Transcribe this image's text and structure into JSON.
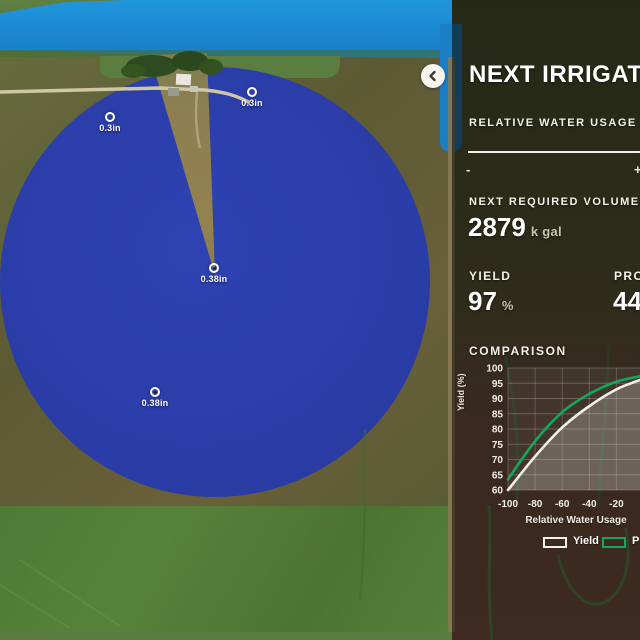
{
  "map": {
    "markers": [
      {
        "x": 252,
        "y": 92,
        "label": "0.3in",
        "dot": false
      },
      {
        "x": 110,
        "y": 117,
        "label": "0.3in",
        "dot": false
      },
      {
        "x": 214,
        "y": 268,
        "label": "0.38in",
        "dot": true
      },
      {
        "x": 155,
        "y": 392,
        "label": "0.38in",
        "dot": true
      }
    ]
  },
  "panel": {
    "title": "NEXT IRRIGATION",
    "water_usage": {
      "label": "RELATIVE WATER USAGE",
      "min_label": "-",
      "max_label": "+"
    },
    "required_volume": {
      "label": "NEXT REQUIRED VOLUME",
      "value": "2879",
      "unit": "k gal"
    },
    "yield_stat": {
      "label": "YIELD",
      "value": "97",
      "unit": "%"
    },
    "profit_stat": {
      "label": "PROFIT",
      "value": "44"
    },
    "comparison_label": "COMPARISON"
  },
  "chart_data": {
    "type": "line",
    "title": "COMPARISON",
    "x": [
      -100,
      -80,
      -60,
      -40,
      -20,
      0
    ],
    "series": [
      {
        "name": "Yield",
        "color": "#f2f2ea",
        "fill": true,
        "values": [
          60,
          71,
          80.5,
          87.5,
          93,
          96.5
        ]
      },
      {
        "name": "Profit",
        "color": "#14a75a",
        "fill": false,
        "values": [
          63.5,
          76,
          85.5,
          91.5,
          95.5,
          97.5
        ]
      }
    ],
    "xlabel": "Relative Water Usage",
    "ylabel": "Yield (%)",
    "ylim": [
      60,
      100
    ],
    "yticks": [
      60,
      65,
      70,
      75,
      80,
      85,
      90,
      95,
      100
    ],
    "xticks": [
      -100,
      -80,
      -60,
      -40,
      -20,
      0
    ],
    "grid": true,
    "legend_position": "bottom"
  },
  "colors": {
    "pivot_circle_blue": "#2b3da8",
    "lake_blue": "#1b86d2",
    "profit_green": "#14a75a",
    "yield_white": "#f2f2ea",
    "panel_text": "#ffffff"
  }
}
